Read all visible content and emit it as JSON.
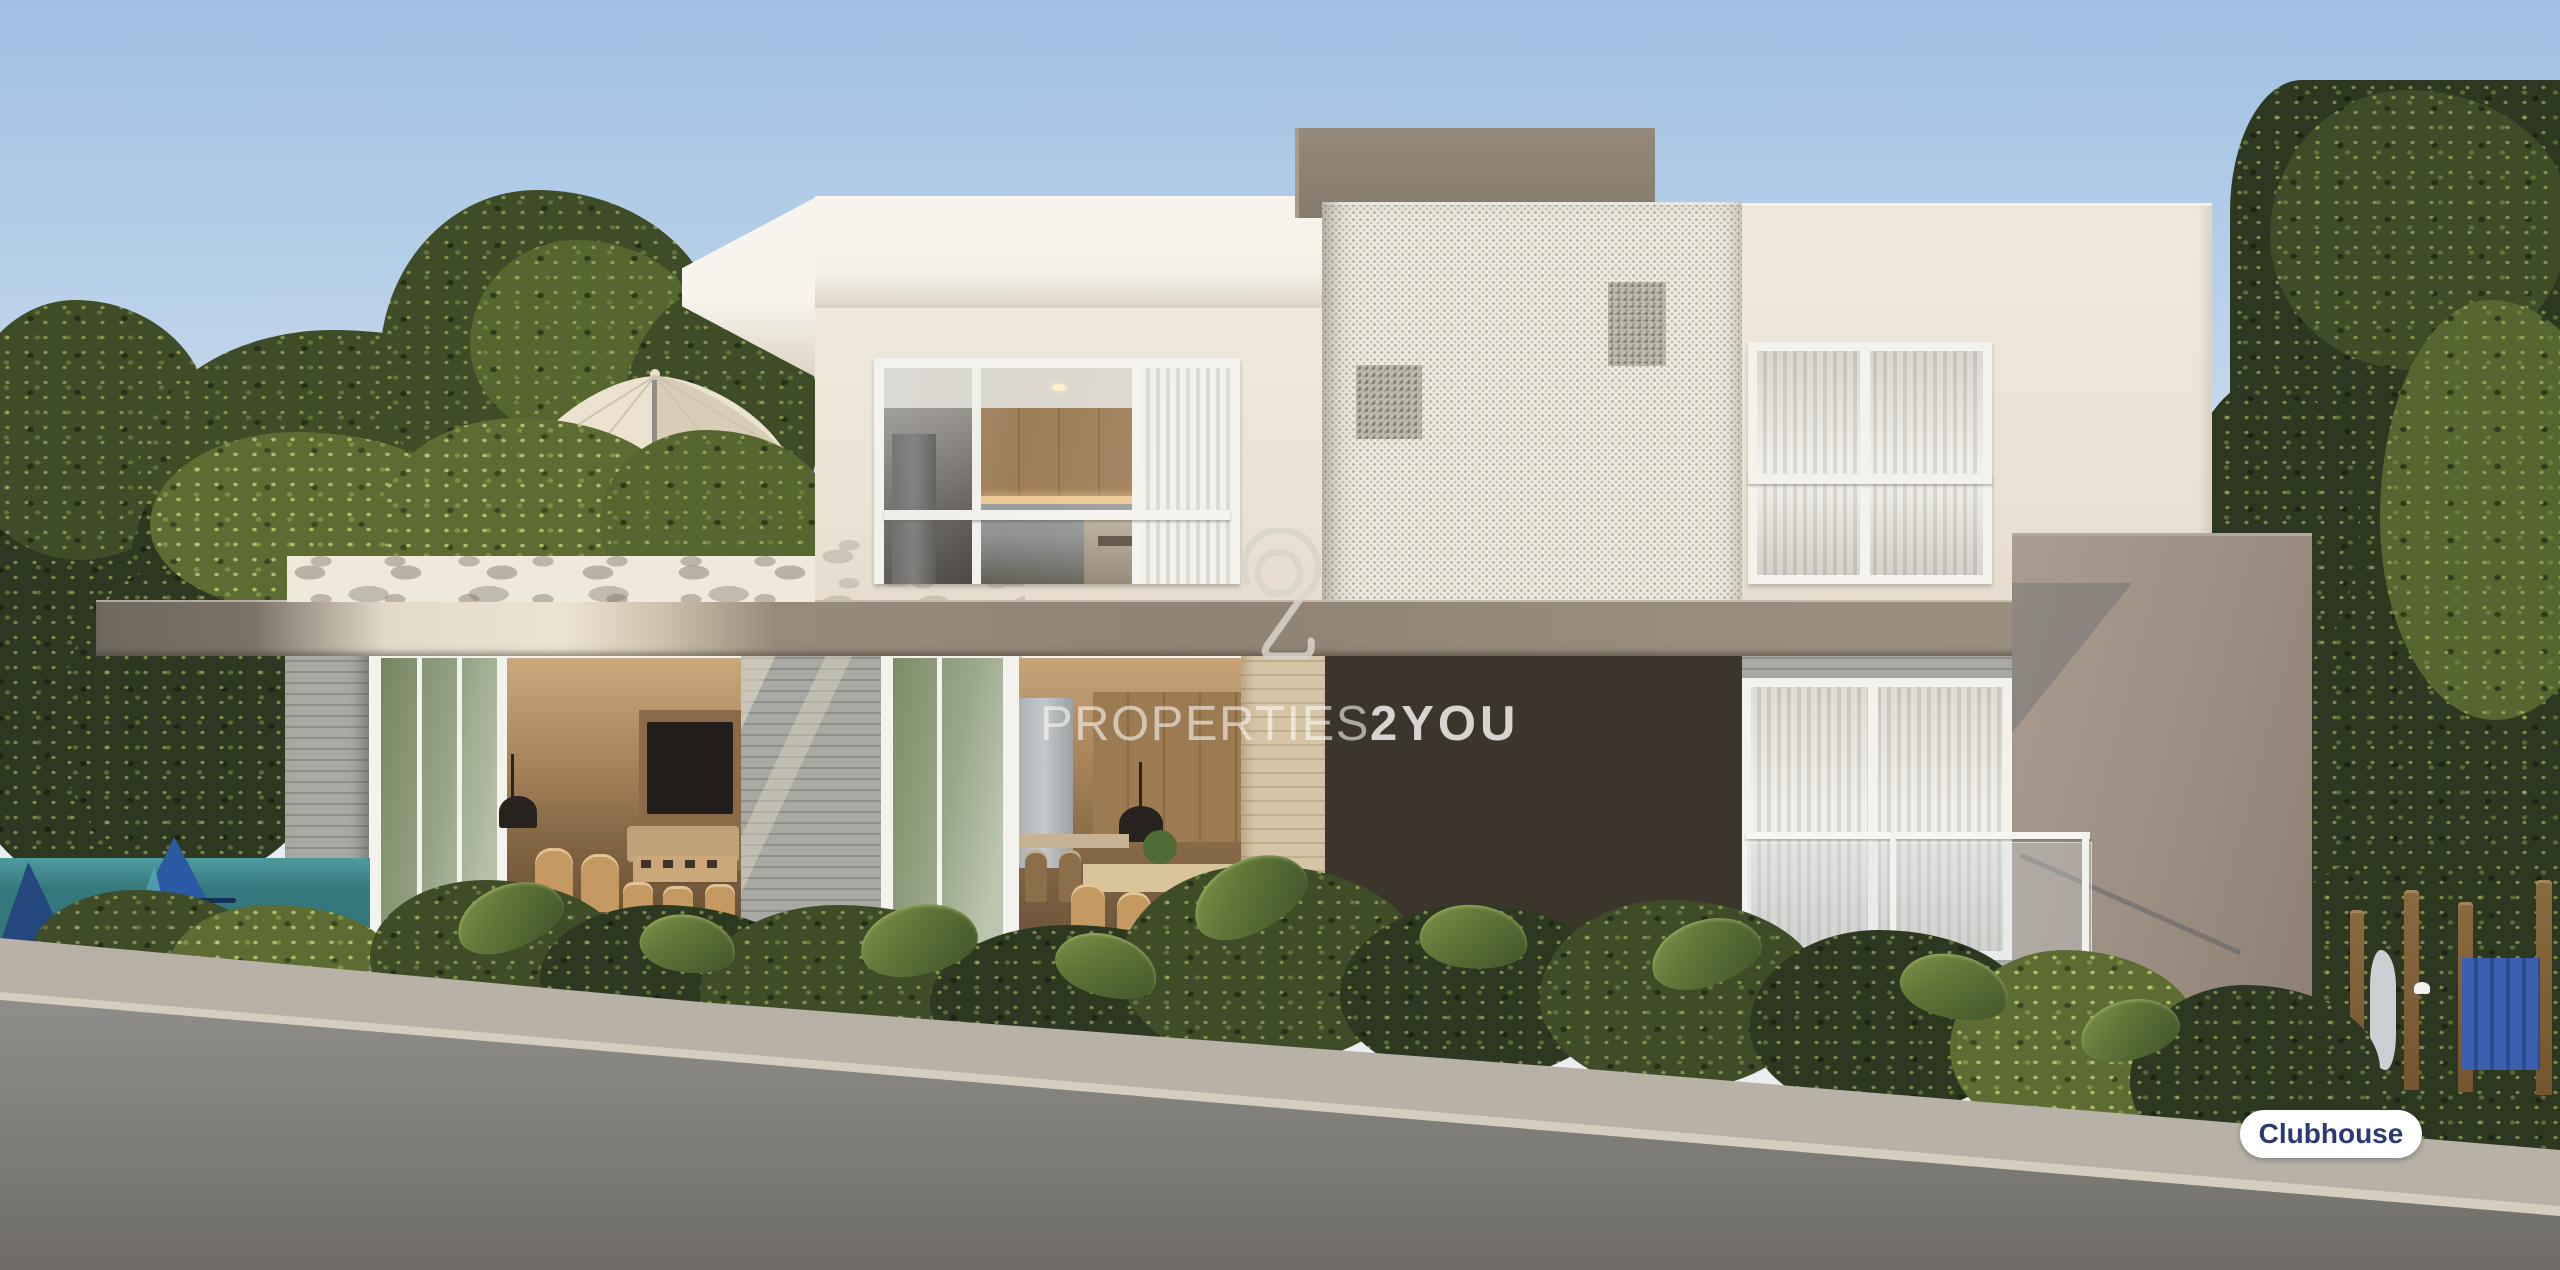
{
  "scene": {
    "type": "architectural-rendering",
    "subject": "Two-story clubhouse exterior with roof terrace, perforated facade screen, pool mural and playground"
  },
  "watermark": {
    "logo_name": "properties2you-logo",
    "brand_thin": "PROPERTIES",
    "brand_bold": "2YOU"
  },
  "badge": {
    "label": "Clubhouse",
    "text_color": "#2b3a70",
    "background_color": "#ffffff"
  },
  "palette": {
    "sky_top": "#9fc0e2",
    "sky_horizon": "#eceff2",
    "wall_cream": "#ece5d8",
    "fascia_white": "#f6f3eb",
    "slab_taupe": "#8f8373",
    "roofbox_brown": "#8a7e6e",
    "screen_white": "#eeebe2",
    "screen_dot": "#bdb7a8",
    "slat_gray": "#9b9e98",
    "wood_tan": "#d3c3a4",
    "foliage_dark": "#2e3a21",
    "foliage_light": "#9aa858",
    "pool_teal": "#2f7175",
    "mural_blue": "#2b59a3",
    "pavement": "#b7b1a6",
    "road": "#7b7974"
  }
}
